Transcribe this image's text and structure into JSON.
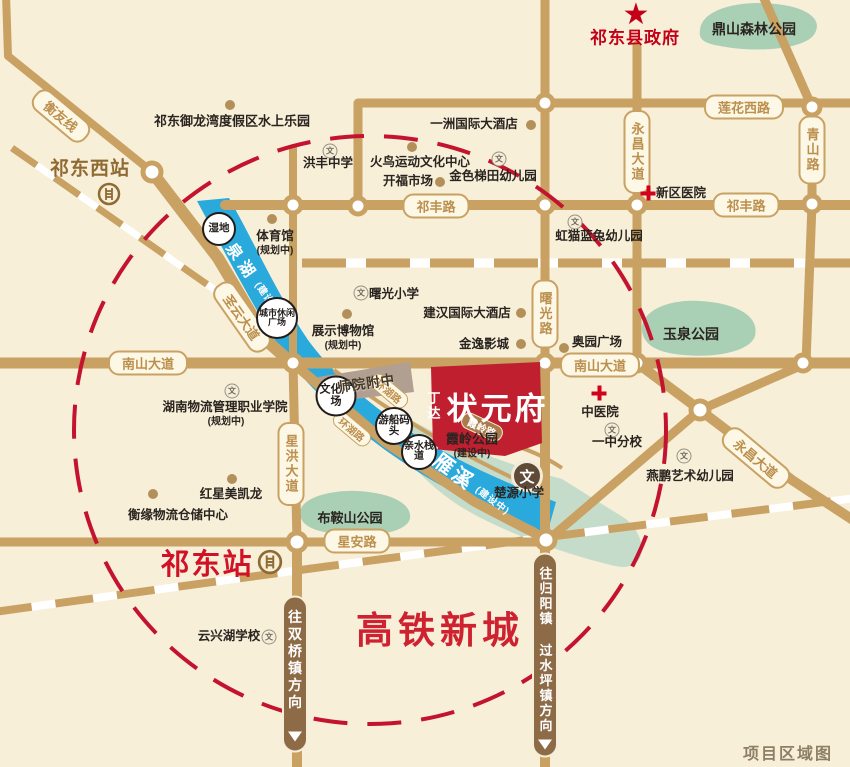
{
  "corner_caption": "项目区域图",
  "project": {
    "brand": "丁达",
    "name": "状元府"
  },
  "government": "祁东县政府",
  "hsr_city": "高铁新城",
  "stations": {
    "west": "祁东西站",
    "main": "祁东站"
  },
  "school_icon_char": "文",
  "wen_badge": "文",
  "road_labels": [
    "衡友线",
    "圣云大道",
    "祁丰路",
    "祁丰路",
    "莲花西路",
    "青山路",
    "永昌大道",
    "曙光路",
    "南山大道",
    "南山大道",
    "星洪大道",
    "星安路",
    "永昌大道",
    "环湖路",
    "环湖路",
    "霞岭路"
  ],
  "direction_labels": [
    "往双桥镇方向",
    "往归阳镇 过水坪镇方向"
  ],
  "waters": [
    {
      "name": "狮泉湖",
      "status": "(建设中)"
    },
    {
      "name": "回雁溪",
      "status": "(建设中)"
    }
  ],
  "parks": [
    {
      "name": "鼎山森林公园"
    },
    {
      "name": "玉泉公园"
    },
    {
      "name": "布鞍山公园"
    },
    {
      "name": "霞岭公园",
      "status": "(建设中)"
    }
  ],
  "circle_markers": [
    "湿地",
    "城市休闲广场",
    "文化广场",
    "游船码头",
    "亲水栈道"
  ],
  "block_label": "师院附中",
  "pois": [
    {
      "name": "祁东御龙湾度假区水上乐园"
    },
    {
      "name": "一洲国际大酒店"
    },
    {
      "name": "火鸟运动文化中心"
    },
    {
      "name": "开福市场"
    },
    {
      "name": "体育馆",
      "status": "(规划中)"
    },
    {
      "name": "展示博物馆",
      "status": "(规划中)"
    },
    {
      "name": "建汉国际大酒店"
    },
    {
      "name": "金逸影城"
    },
    {
      "name": "奥园广场"
    },
    {
      "name": "红星美凯龙"
    },
    {
      "name": "衡缘物流仓储中心"
    },
    {
      "name": "湖南物流管理职业学院",
      "status": "(规划中)"
    },
    {
      "name": "虹猫蓝兔幼儿园"
    },
    {
      "name": "洪丰中学"
    },
    {
      "name": "金色梯田幼儿园"
    },
    {
      "name": "曙光小学"
    },
    {
      "name": "一中分校"
    },
    {
      "name": "燕鹏艺术幼儿园"
    },
    {
      "name": "云兴湖学校"
    },
    {
      "name": "楚源小学"
    },
    {
      "name": "新区医院"
    },
    {
      "name": "中医院"
    }
  ],
  "colors": {
    "road": "#c9a163",
    "water": "#2aa9dc",
    "park": "#a9cfb5",
    "accent_red": "#c3132f",
    "project_red": "#c01f2f",
    "background": "#f8efd8"
  }
}
